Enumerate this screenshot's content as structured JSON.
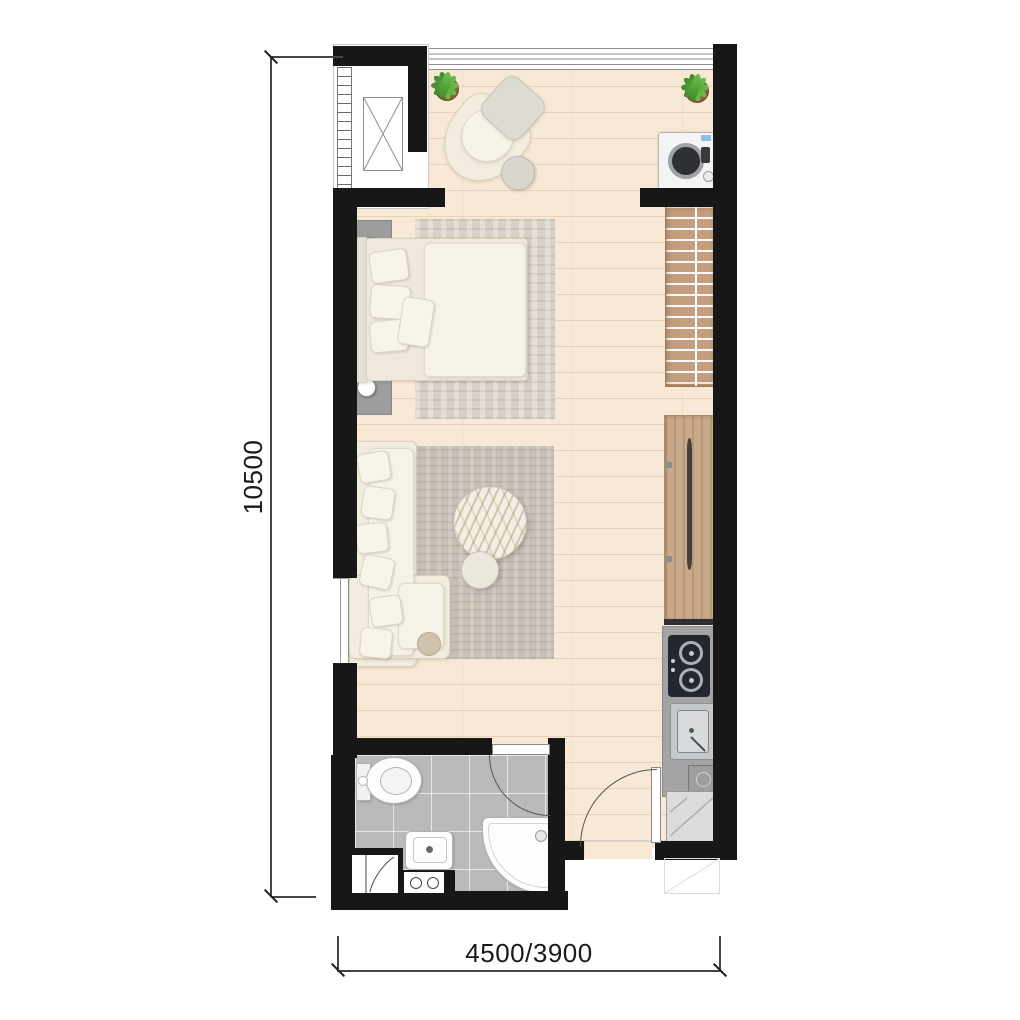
{
  "plan": {
    "type": "studio-apartment-floor-plan",
    "dimension_labels": {
      "height": "10500",
      "width": "4500/3900"
    },
    "colors": {
      "wall": "#171717",
      "wood_floor": "#f7e9d5",
      "bathroom_tile": "#bababc",
      "wardrobe_wood": "#c49f7e",
      "console_wood": "#c9ab8b",
      "kitchen_counter": "#a4a4a6",
      "stove": "#23282e",
      "rug_bedroom": "#d9d1c8",
      "rug_living": "#c8c0b6",
      "upholstery_cream": "#f2edde",
      "plant_green": "#57a13b",
      "dimension_line": "#454545"
    },
    "fixtures": [
      "ac-condenser-unit",
      "louver-screen",
      "north-window",
      "west-window",
      "potted-plant",
      "armchair",
      "ottoman",
      "round-side-table",
      "washing-machine",
      "open-wardrobe",
      "double-bed",
      "nightstand",
      "table-lamp",
      "bedroom-rug",
      "living-rug",
      "l-shaped-sofa",
      "marble-coffee-table",
      "tv-console",
      "tv",
      "kitchen-counter",
      "two-burner-stove",
      "kitchen-sink",
      "under-counter-unit",
      "fridge",
      "entry-door",
      "bathroom-door",
      "toilet",
      "wash-basin",
      "corner-shower",
      "service-niche",
      "meter-box"
    ]
  }
}
